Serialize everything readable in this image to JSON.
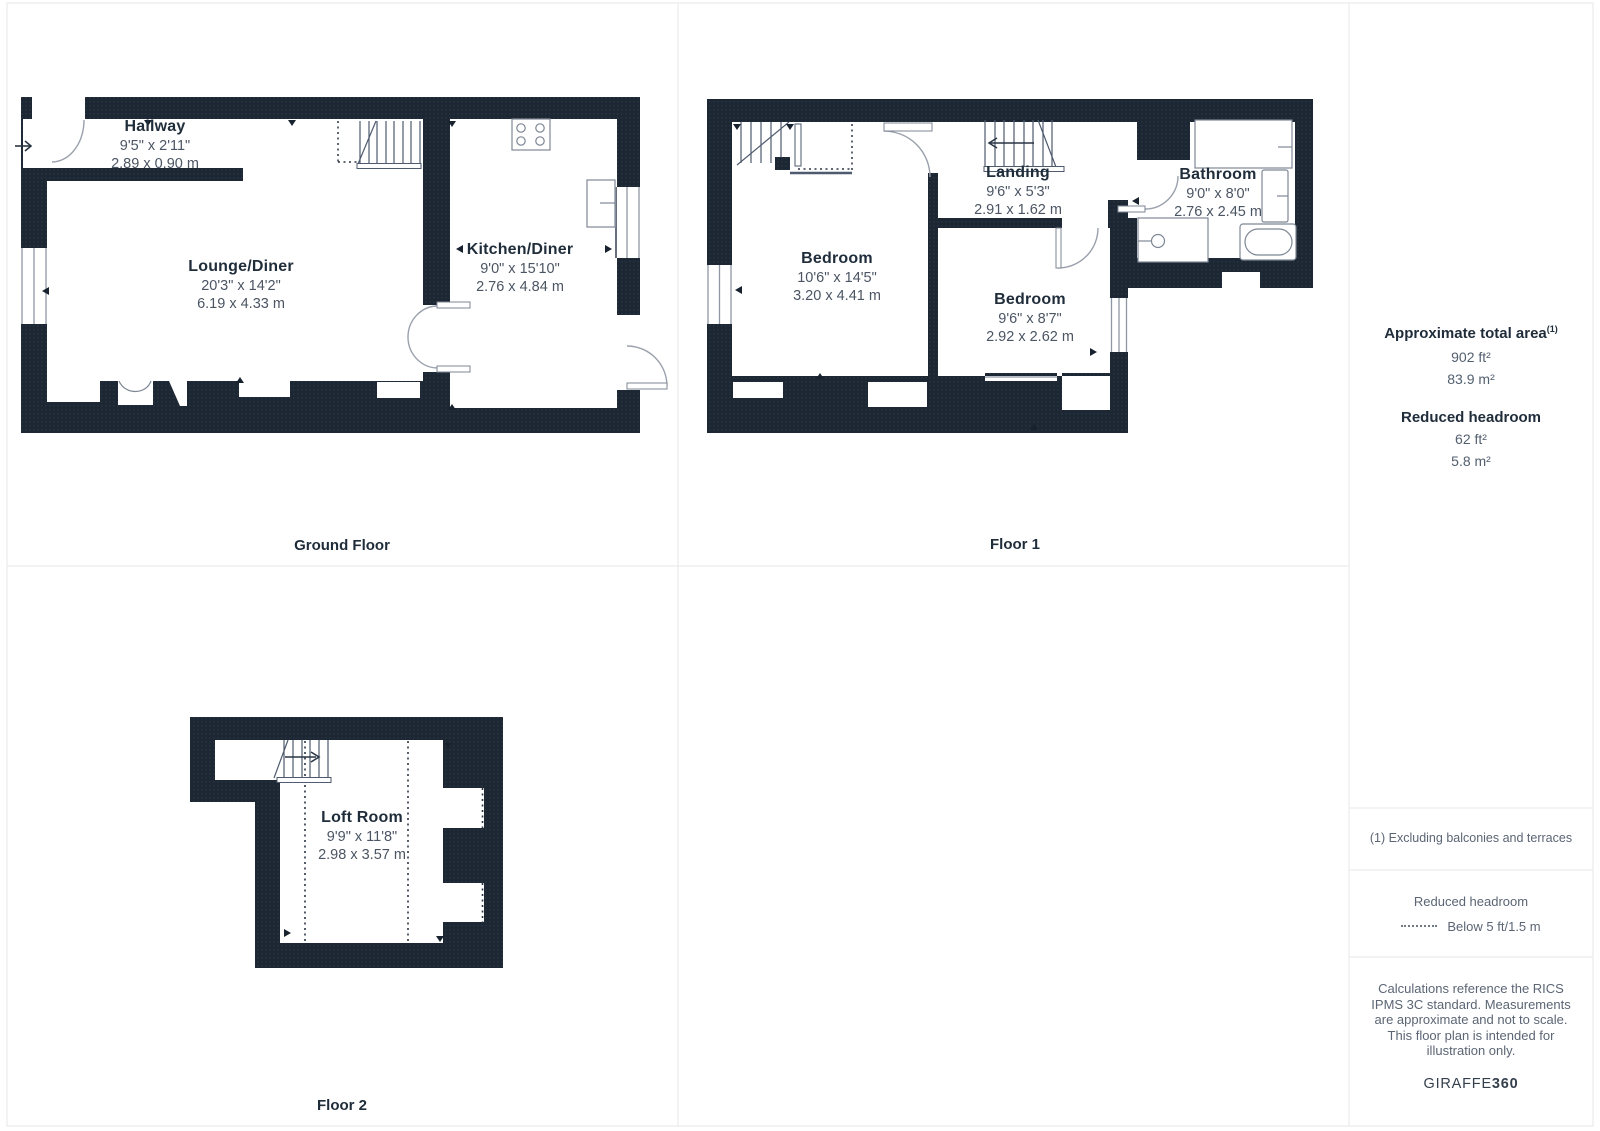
{
  "floors": {
    "ground": {
      "title": "Ground Floor",
      "rooms": [
        {
          "name": "Hallway",
          "imperial": "9'5\" x 2'11\"",
          "metric": "2.89 x 0.90 m"
        },
        {
          "name": "Lounge/Diner",
          "imperial": "20'3\" x 14'2\"",
          "metric": "6.19 x 4.33 m"
        },
        {
          "name": "Kitchen/Diner",
          "imperial": "9'0\" x 15'10\"",
          "metric": "2.76 x 4.84 m"
        }
      ]
    },
    "floor1": {
      "title": "Floor 1",
      "rooms": [
        {
          "name": "Bedroom",
          "imperial": "10'6\" x 14'5\"",
          "metric": "3.20 x 4.41 m"
        },
        {
          "name": "Bedroom",
          "imperial": "9'6\" x 8'7\"",
          "metric": "2.92 x 2.62 m"
        },
        {
          "name": "Landing",
          "imperial": "9'6\" x 5'3\"",
          "metric": "2.91 x 1.62 m"
        },
        {
          "name": "Bathroom",
          "imperial": "9'0\" x 8'0\"",
          "metric": "2.76 x 2.45 m"
        }
      ]
    },
    "floor2": {
      "title": "Floor 2",
      "rooms": [
        {
          "name": "Loft Room",
          "imperial": "9'9\" x 11'8\"",
          "metric": "2.98 x 3.57 m"
        }
      ]
    }
  },
  "sidebar": {
    "total_area_heading": "Approximate total area",
    "total_area_footnote_marker": "(1)",
    "total_area_ft": "902 ft²",
    "total_area_m": "83.9 m²",
    "reduced_headroom_heading": "Reduced headroom",
    "reduced_headroom_ft": "62 ft²",
    "reduced_headroom_m": "5.8 m²",
    "footnote": "(1) Excluding balconies and terraces",
    "legend_heading": "Reduced headroom",
    "legend_label": "Below 5 ft/1.5 m",
    "disclaimer": "Calculations reference the RICS IPMS 3C standard. Measurements are approximate and not to scale. This floor plan is intended for illustration only.",
    "brand": {
      "name": "GIRAFFE",
      "suffix": "360"
    }
  },
  "colors": {
    "wall": "#1c2733",
    "wall_dot": "#2b3745",
    "line": "#8e96a3",
    "stair_line": "#4e5a6e",
    "text_dark": "#1f2c3a",
    "text_dim": "#4b5563",
    "border": "#e7e7e7"
  }
}
